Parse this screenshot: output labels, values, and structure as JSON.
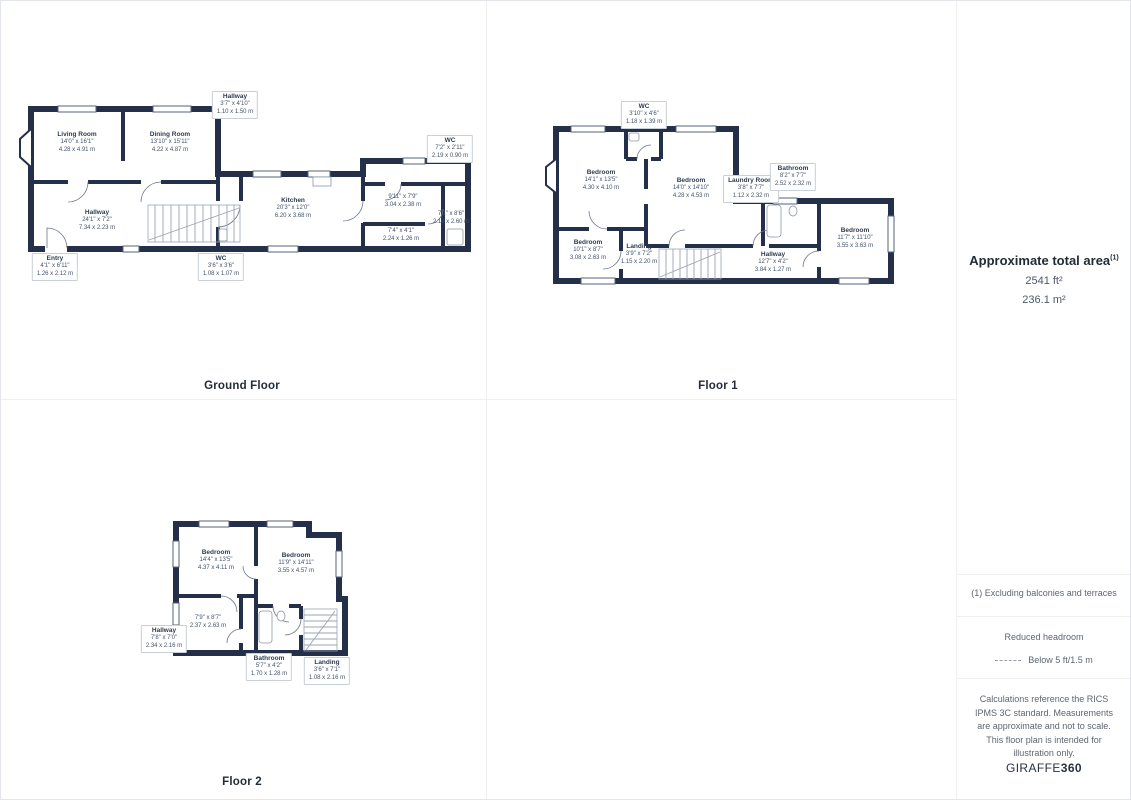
{
  "colors": {
    "wall": "#243049",
    "window_line": "#56617a",
    "stairs": "#9aa6b5",
    "divider": "#edeff2",
    "label_border": "#c8d0da",
    "label_text": "#2d3b50"
  },
  "sidebar": {
    "area_title": "Approximate total area",
    "area_sup": "(1)",
    "area_ft": "2541 ft²",
    "area_m": "236.1 m²",
    "note_balconies": "(1) Excluding balconies and terraces",
    "headroom_title": "Reduced headroom",
    "headroom_value": "Below 5 ft/1.5 m",
    "disclaimer": "Calculations reference the RICS IPMS 3C standard. Measurements are approximate and not to scale. This floor plan is intended for illustration only.",
    "brand_left": "GIRAFFE",
    "brand_right": "360"
  },
  "floors": [
    {
      "title": "Ground Floor",
      "rooms": [
        {
          "name": "Living Room",
          "imperial": "14'0\" x 16'1\"",
          "metric": "4.28 x 4.91 m",
          "x": 64,
          "y": 54,
          "boxed": false
        },
        {
          "name": "Dining Room",
          "imperial": "13'10\" x 15'11\"",
          "metric": "4.22 x 4.87 m",
          "x": 157,
          "y": 54,
          "boxed": false
        },
        {
          "name": "Kitchen",
          "imperial": "20'3\" x 12'0\"",
          "metric": "6.20 x 3.68 m",
          "x": 280,
          "y": 120,
          "boxed": false
        },
        {
          "name": "Hallway",
          "imperial": "24'1\" x 7'2\"",
          "metric": "7.34 x 2.23 m",
          "x": 84,
          "y": 132,
          "boxed": false
        },
        {
          "name": "",
          "imperial": "9'11\" x 7'9\"",
          "metric": "3.04 x 2.38 m",
          "x": 390,
          "y": 113,
          "boxed": false
        },
        {
          "name": "",
          "imperial": "7'4\" x 4'1\"",
          "metric": "2.24 x 1.26 m",
          "x": 388,
          "y": 147,
          "boxed": false
        },
        {
          "name": "",
          "imperial": "7'1\" x 8'6\"",
          "metric": "2.16 x 2.60 m",
          "x": 438,
          "y": 130,
          "boxed": false
        },
        {
          "name": "Hallway",
          "imperial": "3'7\" x 4'10\"",
          "metric": "1.10 x 1.50 m",
          "x": 222,
          "y": 16,
          "boxed": true
        },
        {
          "name": "WC",
          "imperial": "7'2\" x 2'11\"",
          "metric": "2.19 x 0.90 m",
          "x": 437,
          "y": 60,
          "boxed": true
        },
        {
          "name": "Entry",
          "imperial": "4'1\" x 6'11\"",
          "metric": "1.26 x 2.12 m",
          "x": 42,
          "y": 178,
          "boxed": true
        },
        {
          "name": "WC",
          "imperial": "3'6\" x 3'6\"",
          "metric": "1.08 x 1.07 m",
          "x": 208,
          "y": 178,
          "boxed": true
        }
      ]
    },
    {
      "title": "Floor 1",
      "rooms": [
        {
          "name": "Bedroom",
          "imperial": "14'1\" x 13'5\"",
          "metric": "4.30 x 4.10 m",
          "x": 60,
          "y": 80,
          "boxed": false
        },
        {
          "name": "Bedroom",
          "imperial": "14'0\" x 14'10\"",
          "metric": "4.28 x 4.53 m",
          "x": 150,
          "y": 88,
          "boxed": false
        },
        {
          "name": "Bedroom",
          "imperial": "10'1\" x 8'7\"",
          "metric": "3.08 x 2.63 m",
          "x": 47,
          "y": 150,
          "boxed": false
        },
        {
          "name": "Landing",
          "imperial": "3'9\" x 7'2\"",
          "metric": "1.15 x 2.20 m",
          "x": 98,
          "y": 154,
          "boxed": false
        },
        {
          "name": "WC",
          "imperial": "3'10\" x 4'6\"",
          "metric": "1.18 x 1.39 m",
          "x": 103,
          "y": 14,
          "boxed": true
        },
        {
          "name": "Laundry Room",
          "imperial": "3'8\" x 7'7\"",
          "metric": "1.12 x 2.32 m",
          "x": 210,
          "y": 88,
          "boxed": true
        },
        {
          "name": "Bathroom",
          "imperial": "8'2\" x 7'7\"",
          "metric": "2.52 x 2.32 m",
          "x": 252,
          "y": 76,
          "boxed": true
        },
        {
          "name": "Hallway",
          "imperial": "12'7\" x 4'2\"",
          "metric": "3.84 x 1.27 m",
          "x": 232,
          "y": 162,
          "boxed": false
        },
        {
          "name": "Bedroom",
          "imperial": "11'7\" x 11'10\"",
          "metric": "3.55 x 3.63 m",
          "x": 314,
          "y": 138,
          "boxed": false
        }
      ]
    },
    {
      "title": "Floor 2",
      "rooms": [
        {
          "name": "Bedroom",
          "imperial": "14'4\" x 13'5\"",
          "metric": "4.37 x 4.11 m",
          "x": 75,
          "y": 50,
          "boxed": false
        },
        {
          "name": "Bedroom",
          "imperial": "11'9\" x 14'11\"",
          "metric": "3.55 x 4.57 m",
          "x": 155,
          "y": 53,
          "boxed": false
        },
        {
          "name": "",
          "imperial": "7'9\" x 8'7\"",
          "metric": "2.37 x 2.63 m",
          "x": 67,
          "y": 112,
          "boxed": false
        },
        {
          "name": "Hallway",
          "imperial": "7'8\" x 7'0\"",
          "metric": "2.34 x 2.16 m",
          "x": 23,
          "y": 128,
          "boxed": true
        },
        {
          "name": "Bathroom",
          "imperial": "5'7\" x 4'2\"",
          "metric": "1.70 x 1.28 m",
          "x": 128,
          "y": 156,
          "boxed": true
        },
        {
          "name": "Landing",
          "imperial": "3'6\" x 7'1\"",
          "metric": "1.08 x 2.16 m",
          "x": 186,
          "y": 160,
          "boxed": true
        }
      ]
    }
  ]
}
